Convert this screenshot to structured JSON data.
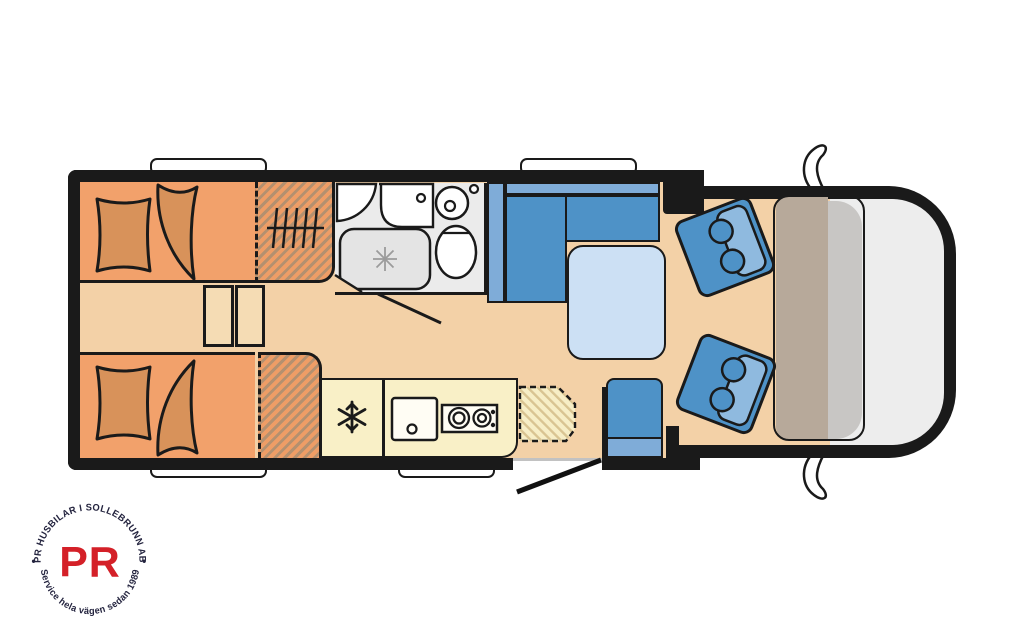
{
  "title": "Motorhome floor plan",
  "palette": {
    "wall": "#1a1a1a",
    "floor": "#f3d1a7",
    "bed": "#f2a16b",
    "bedding": "#d8925a",
    "wardrobe_stripe": "#a97f5c",
    "kitchen": "#f9f0c7",
    "bathroom": "#ebebeb",
    "shower": "#e4e4e4",
    "upholstery": "#4e92c7",
    "upholstery_light": "#7facd8",
    "seatback_light": "#8fbadf",
    "table": "#cce0f4",
    "dashboard": "#b7a99a",
    "windshield": "#c8c6c4",
    "hood": "#ededed",
    "window": "#ffffff"
  },
  "areas": [
    "rear twin beds",
    "wardrobes",
    "bathroom",
    "kitchen",
    "dinette",
    "entry door",
    "swivel cab seats",
    "driver cab"
  ],
  "icons": {
    "fridge": "snowflake-icon",
    "shower": "drain-star-icon",
    "wardrobe": "hanging-rail-icon",
    "mirrors": "wing-mirror-icon"
  },
  "logo": {
    "top_text": "PR HUSBILAR I SOLLEBRUNN AB",
    "bottom_text": "Service hela vägen sedan 1989",
    "center_text": "PR",
    "separator": "•",
    "accent": "#d42028",
    "text_color": "#23233e"
  }
}
